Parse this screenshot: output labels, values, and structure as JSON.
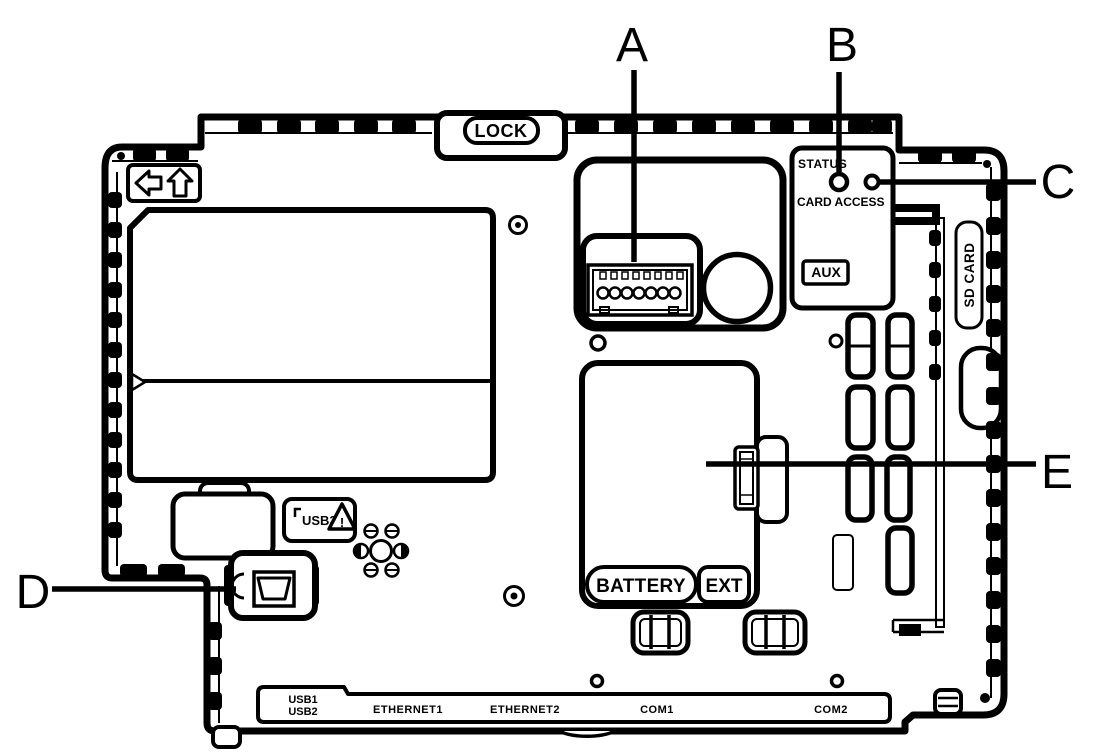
{
  "diagram": {
    "type": "hardware-rear-view-line-drawing",
    "callouts": {
      "a": "A",
      "b": "B",
      "c": "C",
      "d": "D",
      "e": "E"
    },
    "labels": {
      "lock": "LOCK",
      "status": "STATUS",
      "card_access": "CARD ACCESS",
      "aux": "AUX",
      "sd_card": "SD CARD",
      "usb3": "USB3",
      "warning_mark": "!",
      "battery": "BATTERY",
      "ext": "EXT",
      "usb1": "USB1",
      "usb2": "USB2",
      "ethernet1": "ETHERNET1",
      "ethernet2": "ETHERNET2",
      "com1": "COM1",
      "com2": "COM2"
    },
    "icons": {
      "left_arrow": "left-arrow-icon",
      "up_arrow": "up-arrow-icon",
      "warning": "warning-triangle-icon",
      "status_led": "status-led",
      "card_access_led": "card-access-led"
    },
    "colors": {
      "line": "#000000",
      "background": "#ffffff"
    }
  }
}
